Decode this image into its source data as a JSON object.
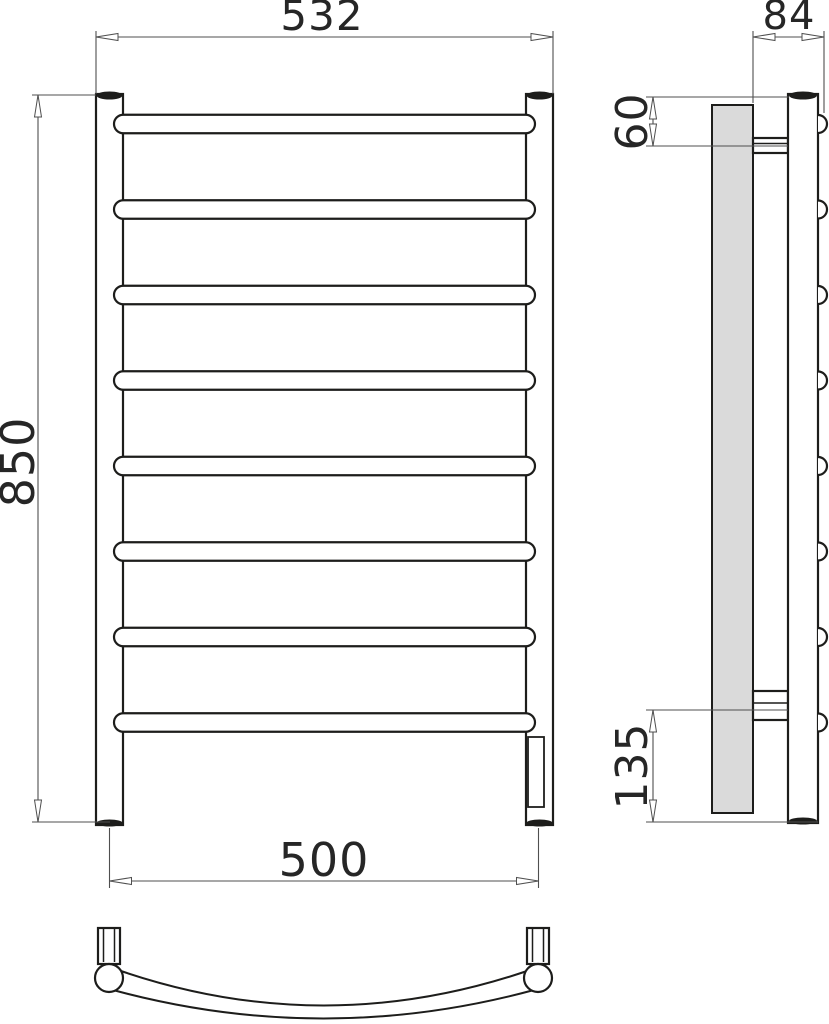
{
  "dimensions": {
    "overall_width_mm": "532",
    "depth_mm": "84",
    "overall_height_mm": "850",
    "top_bracket_offset_mm": "60",
    "mounting_width_mm": "500",
    "bottom_bracket_offset_mm": "135"
  },
  "structure": {
    "rung_count": 8,
    "post_count": 2,
    "bracket_count": 2
  },
  "colors": {
    "object_line": "#1d1d1b",
    "dimension_line": "#4f4f4f",
    "wall_plate_fill": "#dadada",
    "background": "#ffffff"
  }
}
